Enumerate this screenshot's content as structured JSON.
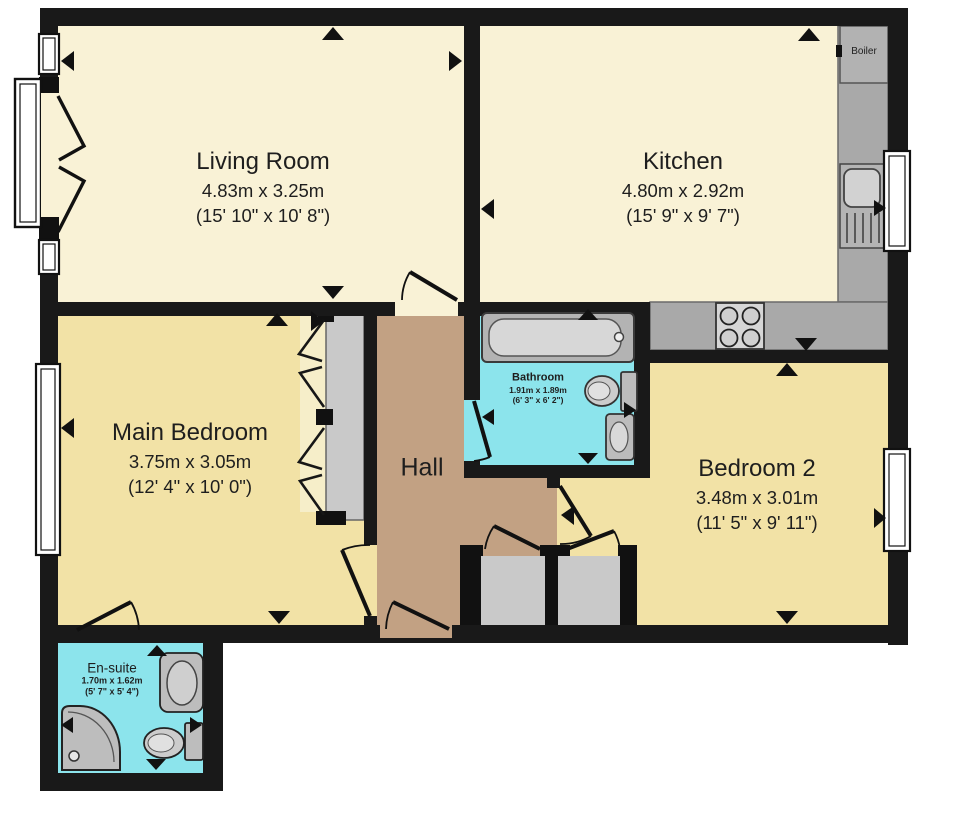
{
  "title": "Two bedroom flat floorplan",
  "colors": {
    "wall": "#191919",
    "living": "#f9f2d6",
    "bedroom": "#f2e2a6",
    "hall": "#c2a183",
    "wet": "#8ce4ec",
    "counter": "#a9a9a9",
    "cabinet": "#c9c9c9",
    "fixture": "#bdbdbd",
    "outside": "#ffffff"
  },
  "rooms": {
    "living_room": {
      "name": "Living Room",
      "metric": "4.83m x 3.25m",
      "imperial": "(15' 10\" x 10' 8\")"
    },
    "kitchen": {
      "name": "Kitchen",
      "metric": "4.80m x 2.92m",
      "imperial": "(15' 9\" x 9' 7\")"
    },
    "main_bedroom": {
      "name": "Main Bedroom",
      "metric": "3.75m x 3.05m",
      "imperial": "(12' 4\" x 10' 0\")"
    },
    "bedroom_2": {
      "name": "Bedroom 2",
      "metric": "3.48m x 3.01m",
      "imperial": "(11' 5\" x 9' 11\")"
    },
    "bathroom": {
      "name": "Bathroom",
      "metric": "1.91m x 1.89m",
      "imperial": "(6' 3\" x 6' 2\")"
    },
    "en_suite": {
      "name": "En-suite",
      "metric": "1.70m x 1.62m",
      "imperial": "(5' 7\" x 5' 4\")"
    },
    "hall": {
      "name": "Hall"
    }
  },
  "labels": {
    "boiler": "Boiler"
  }
}
